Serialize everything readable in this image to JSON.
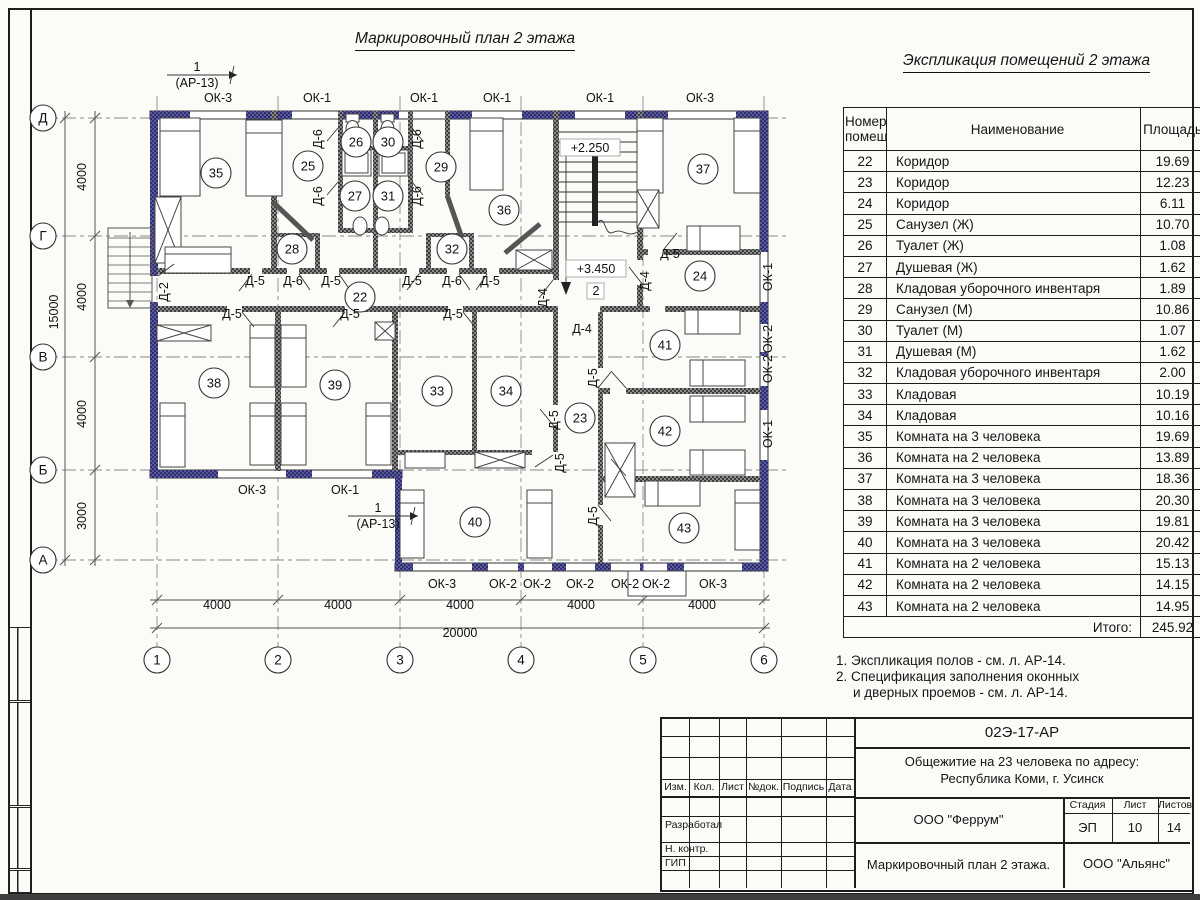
{
  "sheet": {
    "plan_title": "Маркировочный план 2 этажа",
    "table_title": "Экспликация помещений 2 этажа",
    "notes": [
      "1. Экспликация полов - см. л. АР-14.",
      "2. Спецификация заполнения оконных",
      "и дверных проемов - см. л. АР-14."
    ]
  },
  "colors": {
    "wall_exterior": "#3c3c7c",
    "wall_interior": "#4a4a4a",
    "window_accent": "#2c2c96",
    "axis_line": "#8a8a8a"
  },
  "explication": {
    "headers": {
      "number_line1": "Номер",
      "number_line2": "помещ.",
      "name": "Наименование",
      "area": "Площадь",
      "cat_line1": "Ка",
      "cat_line2": "по"
    },
    "rows": [
      {
        "n": "22",
        "name": "Коридор",
        "area": "19.69"
      },
      {
        "n": "23",
        "name": "Коридор",
        "area": "12.23"
      },
      {
        "n": "24",
        "name": "Коридор",
        "area": "6.11"
      },
      {
        "n": "25",
        "name": "Санузел (Ж)",
        "area": "10.70"
      },
      {
        "n": "26",
        "name": "Туалет (Ж)",
        "area": "1.08"
      },
      {
        "n": "27",
        "name": "Душевая (Ж)",
        "area": "1.62"
      },
      {
        "n": "28",
        "name": "Кладовая уборочного инвентаря",
        "area": "1.89"
      },
      {
        "n": "29",
        "name": "Санузел (М)",
        "area": "10.86"
      },
      {
        "n": "30",
        "name": "Туалет (М)",
        "area": "1.07"
      },
      {
        "n": "31",
        "name": "Душевая (М)",
        "area": "1.62"
      },
      {
        "n": "32",
        "name": "Кладовая уборочного инвентаря",
        "area": "2.00"
      },
      {
        "n": "33",
        "name": "Кладовая",
        "area": "10.19"
      },
      {
        "n": "34",
        "name": "Кладовая",
        "area": "10.16"
      },
      {
        "n": "35",
        "name": "Комната на 3 человека",
        "area": "19.69"
      },
      {
        "n": "36",
        "name": "Комната на 2 человека",
        "area": "13.89"
      },
      {
        "n": "37",
        "name": "Комната на 3 человека",
        "area": "18.36"
      },
      {
        "n": "38",
        "name": "Комната на 3 человека",
        "area": "20.30"
      },
      {
        "n": "39",
        "name": "Комната на 3 человека",
        "area": "19.81"
      },
      {
        "n": "40",
        "name": "Комната на 3 человека",
        "area": "20.42"
      },
      {
        "n": "41",
        "name": "Комната на 2 человека",
        "area": "15.13"
      },
      {
        "n": "42",
        "name": "Комната на 2 человека",
        "area": "14.15"
      },
      {
        "n": "43",
        "name": "Комната на 2 человека",
        "area": "14.95"
      }
    ],
    "total_label": "Итого:",
    "total_value": "245.92"
  },
  "titleblock": {
    "doc_code": "02Э-17-АР",
    "object_line1": "Общежитие на 23 человека по адресу:",
    "object_line2": "Республика Коми, г. Усинск",
    "designer_org": "ООО \"Феррум\"",
    "stage_label": "Стадия",
    "sheet_label": "Лист",
    "sheets_label": "Листов",
    "stage": "ЭП",
    "sheet_no": "10",
    "sheets_total": "14",
    "drawing_name": "Маркировочный план 2 этажа.",
    "contractor_org": "ООО \"Альянс\"",
    "sign_cols": [
      "Изм.",
      "Кол.",
      "Лист",
      "№док.",
      "Подпись",
      "Дата"
    ],
    "roles": [
      "Разработал",
      "Н. контр.",
      "ГИП"
    ]
  },
  "plan": {
    "rooms": [
      {
        "n": "22",
        "x": 360,
        "y": 297
      },
      {
        "n": "23",
        "x": 580,
        "y": 418
      },
      {
        "n": "24",
        "x": 700,
        "y": 276
      },
      {
        "n": "25",
        "x": 308,
        "y": 166
      },
      {
        "n": "26",
        "x": 356,
        "y": 142
      },
      {
        "n": "27",
        "x": 355,
        "y": 196
      },
      {
        "n": "28",
        "x": 292,
        "y": 249
      },
      {
        "n": "29",
        "x": 441,
        "y": 167
      },
      {
        "n": "30",
        "x": 388,
        "y": 142
      },
      {
        "n": "31",
        "x": 388,
        "y": 196
      },
      {
        "n": "32",
        "x": 452,
        "y": 249
      },
      {
        "n": "33",
        "x": 437,
        "y": 391
      },
      {
        "n": "34",
        "x": 506,
        "y": 391
      },
      {
        "n": "35",
        "x": 216,
        "y": 173
      },
      {
        "n": "36",
        "x": 504,
        "y": 210
      },
      {
        "n": "37",
        "x": 703,
        "y": 169
      },
      {
        "n": "38",
        "x": 214,
        "y": 383
      },
      {
        "n": "39",
        "x": 335,
        "y": 385
      },
      {
        "n": "40",
        "x": 475,
        "y": 522
      },
      {
        "n": "41",
        "x": 665,
        "y": 345
      },
      {
        "n": "42",
        "x": 665,
        "y": 431
      },
      {
        "n": "43",
        "x": 684,
        "y": 528
      }
    ],
    "window_labels": [
      {
        "t": "ОК-3",
        "x": 218,
        "y": 102
      },
      {
        "t": "ОК-1",
        "x": 317,
        "y": 102
      },
      {
        "t": "ОК-1",
        "x": 424,
        "y": 102
      },
      {
        "t": "ОК-1",
        "x": 497,
        "y": 102
      },
      {
        "t": "ОК-1",
        "x": 600,
        "y": 102
      },
      {
        "t": "ОК-3",
        "x": 700,
        "y": 102
      },
      {
        "t": "ОК-3",
        "x": 252,
        "y": 494
      },
      {
        "t": "ОК-1",
        "x": 345,
        "y": 494
      },
      {
        "t": "ОК-3",
        "x": 442,
        "y": 588
      },
      {
        "t": "ОК-2",
        "x": 503,
        "y": 588
      },
      {
        "t": "ОК-2",
        "x": 537,
        "y": 588
      },
      {
        "t": "ОК-2",
        "x": 580,
        "y": 588
      },
      {
        "t": "ОК-2",
        "x": 625,
        "y": 588
      },
      {
        "t": "ОК-2",
        "x": 656,
        "y": 588
      },
      {
        "t": "ОК-3",
        "x": 713,
        "y": 588
      },
      {
        "t": "ОК-1",
        "x": 772,
        "y": 277,
        "r": -90
      },
      {
        "t": "ОК-2",
        "x": 772,
        "y": 339,
        "r": -90
      },
      {
        "t": "ОК-2",
        "x": 772,
        "y": 369,
        "r": -90
      },
      {
        "t": "ОК-1",
        "x": 772,
        "y": 434,
        "r": -90
      }
    ],
    "door_labels": [
      {
        "t": "Д-5",
        "x": 255,
        "y": 285
      },
      {
        "t": "Д-6",
        "x": 293,
        "y": 285
      },
      {
        "t": "Д-5",
        "x": 331,
        "y": 285
      },
      {
        "t": "Д-5",
        "x": 412,
        "y": 285
      },
      {
        "t": "Д-6",
        "x": 452,
        "y": 285
      },
      {
        "t": "Д-5",
        "x": 490,
        "y": 285
      },
      {
        "t": "Д-5",
        "x": 232,
        "y": 318
      },
      {
        "t": "Д-5",
        "x": 350,
        "y": 318
      },
      {
        "t": "Д-5",
        "x": 453,
        "y": 318
      },
      {
        "t": "Д-5",
        "x": 670,
        "y": 258
      },
      {
        "t": "Д-4",
        "x": 649,
        "y": 281,
        "r": -90
      },
      {
        "t": "Д-4",
        "x": 547,
        "y": 298,
        "r": -90
      },
      {
        "t": "Д-4",
        "x": 582,
        "y": 333
      },
      {
        "t": "Д-2",
        "x": 168,
        "y": 292,
        "r": -90
      },
      {
        "t": "Д-6",
        "x": 322,
        "y": 139,
        "r": -90
      },
      {
        "t": "Д-6",
        "x": 421,
        "y": 139,
        "r": -90
      },
      {
        "t": "Д-6",
        "x": 322,
        "y": 196,
        "r": -90
      },
      {
        "t": "Д-6",
        "x": 421,
        "y": 196,
        "r": -90
      },
      {
        "t": "Д-5",
        "x": 558,
        "y": 420,
        "r": -90
      },
      {
        "t": "Д-5",
        "x": 564,
        "y": 463,
        "r": -90
      },
      {
        "t": "Д-5",
        "x": 597,
        "y": 378,
        "r": -90
      },
      {
        "t": "Д-5",
        "x": 597,
        "y": 516,
        "r": -90
      }
    ],
    "dim_labels": [
      {
        "t": "4000",
        "x": 217,
        "y": 609
      },
      {
        "t": "4000",
        "x": 338,
        "y": 609
      },
      {
        "t": "4000",
        "x": 460,
        "y": 609
      },
      {
        "t": "4000",
        "x": 581,
        "y": 609
      },
      {
        "t": "4000",
        "x": 702,
        "y": 609
      },
      {
        "t": "20000",
        "x": 460,
        "y": 637
      },
      {
        "t": "4000",
        "x": 86,
        "y": 177,
        "r": -90
      },
      {
        "t": "4000",
        "x": 86,
        "y": 297,
        "r": -90
      },
      {
        "t": "4000",
        "x": 86,
        "y": 414,
        "r": -90
      },
      {
        "t": "3000",
        "x": 86,
        "y": 516,
        "r": -90
      },
      {
        "t": "15000",
        "x": 58,
        "y": 312,
        "r": -90
      }
    ],
    "axes_bottom": [
      {
        "t": "1",
        "x": 157,
        "y": 660
      },
      {
        "t": "2",
        "x": 278,
        "y": 660
      },
      {
        "t": "3",
        "x": 400,
        "y": 660
      },
      {
        "t": "4",
        "x": 521,
        "y": 660
      },
      {
        "t": "5",
        "x": 643,
        "y": 660
      },
      {
        "t": "6",
        "x": 764,
        "y": 660
      }
    ],
    "axes_left": [
      {
        "t": "Д",
        "x": 43,
        "y": 118
      },
      {
        "t": "Г",
        "x": 43,
        "y": 236
      },
      {
        "t": "В",
        "x": 43,
        "y": 357
      },
      {
        "t": "Б",
        "x": 43,
        "y": 470
      },
      {
        "t": "А",
        "x": 43,
        "y": 560
      }
    ],
    "elevations": [
      {
        "t": "+2.250",
        "x": 590,
        "y": 152,
        "box": [
          560,
          139,
          60,
          17
        ]
      },
      {
        "t": "+3.450",
        "x": 596,
        "y": 273,
        "box": [
          566,
          260,
          60,
          17
        ]
      },
      {
        "t": "2",
        "x": 596,
        "y": 295,
        "box": [
          587,
          283,
          17,
          16
        ]
      }
    ],
    "sections": [
      {
        "num": "1",
        "ref": "(АР-13)",
        "x": 197,
        "y": 71
      },
      {
        "num": "1",
        "ref": "(АР-13)",
        "x": 378,
        "y": 512
      }
    ]
  }
}
